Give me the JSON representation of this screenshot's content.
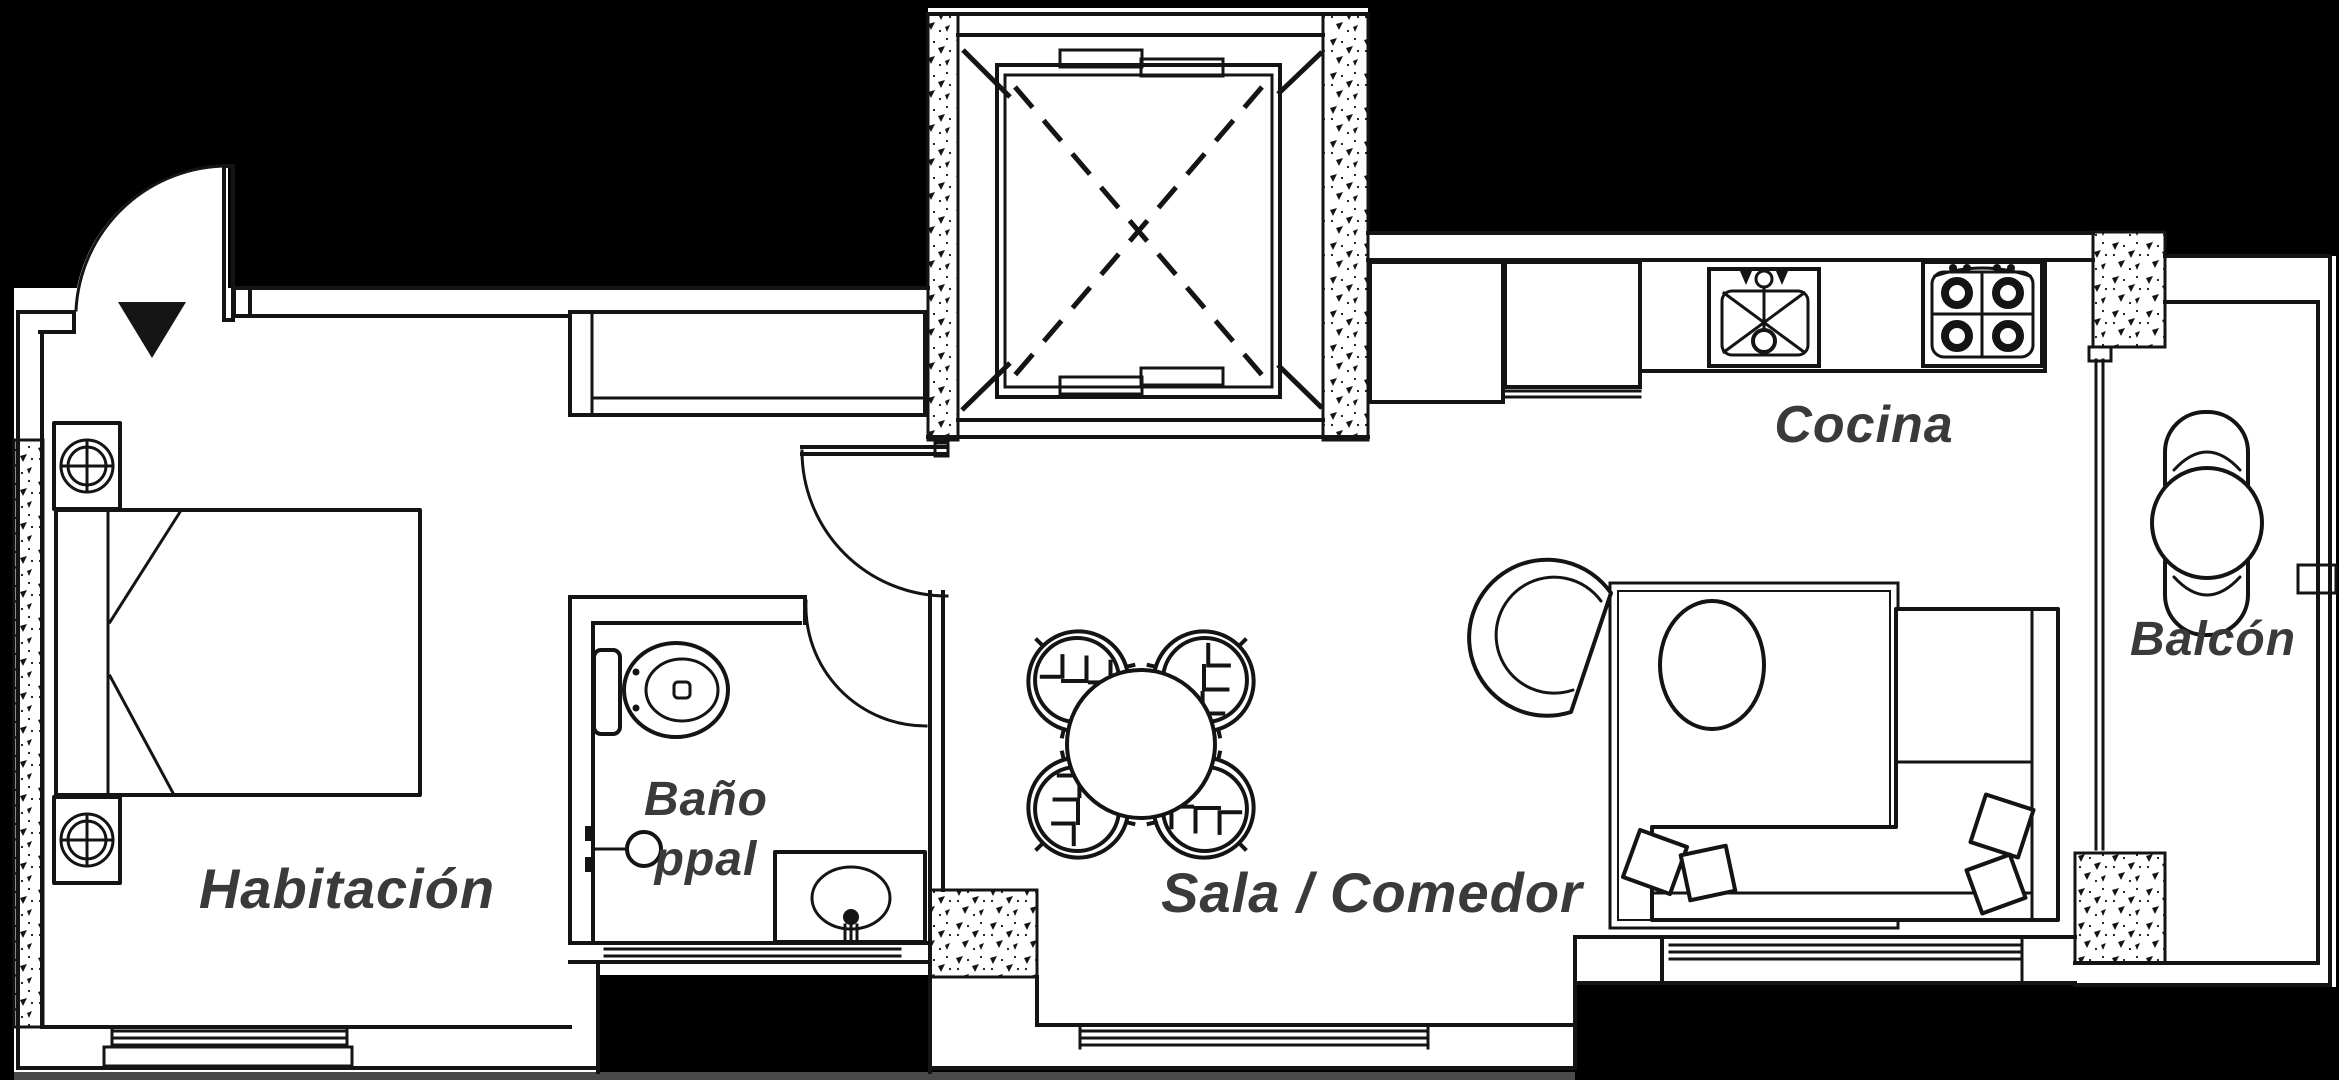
{
  "canvas": {
    "width": 2339,
    "height": 1080
  },
  "palette": {
    "background": "#000000",
    "floor": "#ffffff",
    "line": "#141414",
    "label_text": "#3a3a3a",
    "sill_strip": "#4a4a4a"
  },
  "plan_type": "apartment-floor-plan",
  "rooms": {
    "habitacion": {
      "label": "Habitación"
    },
    "bano": {
      "label": "Baño ppal",
      "line1": "Baño",
      "line2": "ppal"
    },
    "sala": {
      "label": "Sala / Comedor"
    },
    "cocina": {
      "label": "Cocina"
    },
    "balcon": {
      "label": "Balcón"
    }
  },
  "symbols": [
    "entrance-door",
    "entrance-arrow",
    "wardrobe",
    "elevator-shaft",
    "elevator-car",
    "bed",
    "nightstand-lamp",
    "toilet",
    "shower-head",
    "vanity-sink",
    "interior-door",
    "fridge",
    "kitchen-cabinet",
    "kitchen-sink",
    "stove",
    "dining-table",
    "dining-chair",
    "rug",
    "pouf",
    "armchair",
    "sofa",
    "pillow",
    "window",
    "balcony-table",
    "balcony-chair",
    "concrete-pier"
  ]
}
